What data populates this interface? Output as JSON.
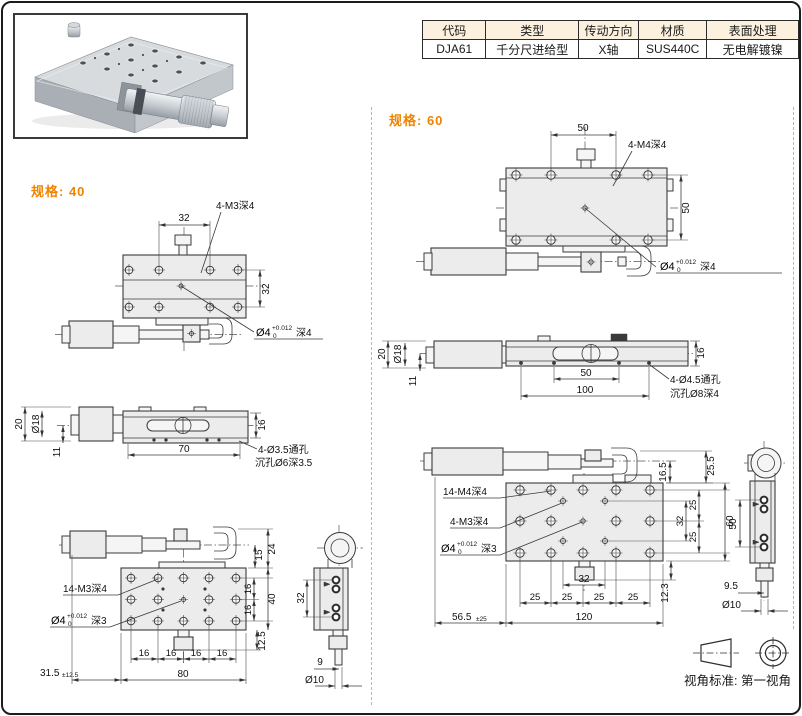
{
  "accent": "#f08300",
  "table": {
    "headers": [
      "代码",
      "类型",
      "传动方向",
      "材质",
      "表面处理"
    ],
    "row": [
      "DJA61",
      "千分尺进给型",
      "X轴",
      "SUS440C",
      "无电解镀镍"
    ]
  },
  "s40": {
    "label": "规格: 40",
    "top": {
      "w": "32",
      "thread": "4-M3深4",
      "h": "32",
      "pin_d": "Ø4",
      "tol_up": "+0.012",
      "tol_dn": "0",
      "pin_depth": "深4"
    },
    "front": {
      "d20": "20",
      "d18": "Ø18",
      "d11": "11",
      "d70": "70",
      "d16": "16",
      "thru": "4-Ø3.5通孔",
      "cbore": "沉孔Ø6深3.5"
    },
    "bottom": {
      "d15": "15",
      "d24": "24",
      "p16": "16",
      "d40": "40",
      "d80": "80",
      "travel": "31.5",
      "travel_tol": "±12.5",
      "d12_5": "12.5",
      "thread": "14-M3深4",
      "pin_d": "Ø4",
      "tol_up": "+0.012",
      "tol_dn": "0",
      "pin_depth": "深3"
    },
    "end": {
      "d32": "32",
      "d9": "9",
      "d10": "Ø10"
    }
  },
  "s60": {
    "label": "规格: 60",
    "top": {
      "w": "50",
      "thread": "4-M4深4",
      "h": "50",
      "pin_d": "Ø4",
      "tol_up": "+0.012",
      "tol_dn": "0",
      "pin_depth": "深4"
    },
    "front": {
      "d20": "20",
      "d18": "Ø18",
      "d11": "11",
      "d50": "50",
      "d100": "100",
      "d16": "16",
      "thru": "4-Ø4.5通孔",
      "cbore": "沉孔Ø8深4"
    },
    "bottom": {
      "d16_5": "16.5",
      "d25_5": "25.5",
      "p25": "25",
      "d32": "32",
      "k32": "32",
      "d60": "60",
      "d12_3": "12.3",
      "d120": "120",
      "travel": "56.5",
      "travel_tol": "±25",
      "thread14": "14-M4深4",
      "thread4": "4-M3深4",
      "pin_d": "Ø4",
      "tol_up": "+0.012",
      "tol_dn": "0",
      "pin_depth": "深3"
    },
    "end": {
      "d50": "50",
      "d9_5": "9.5",
      "d10": "Ø10"
    }
  },
  "footer": {
    "standard": "视角标准: 第一视角"
  }
}
